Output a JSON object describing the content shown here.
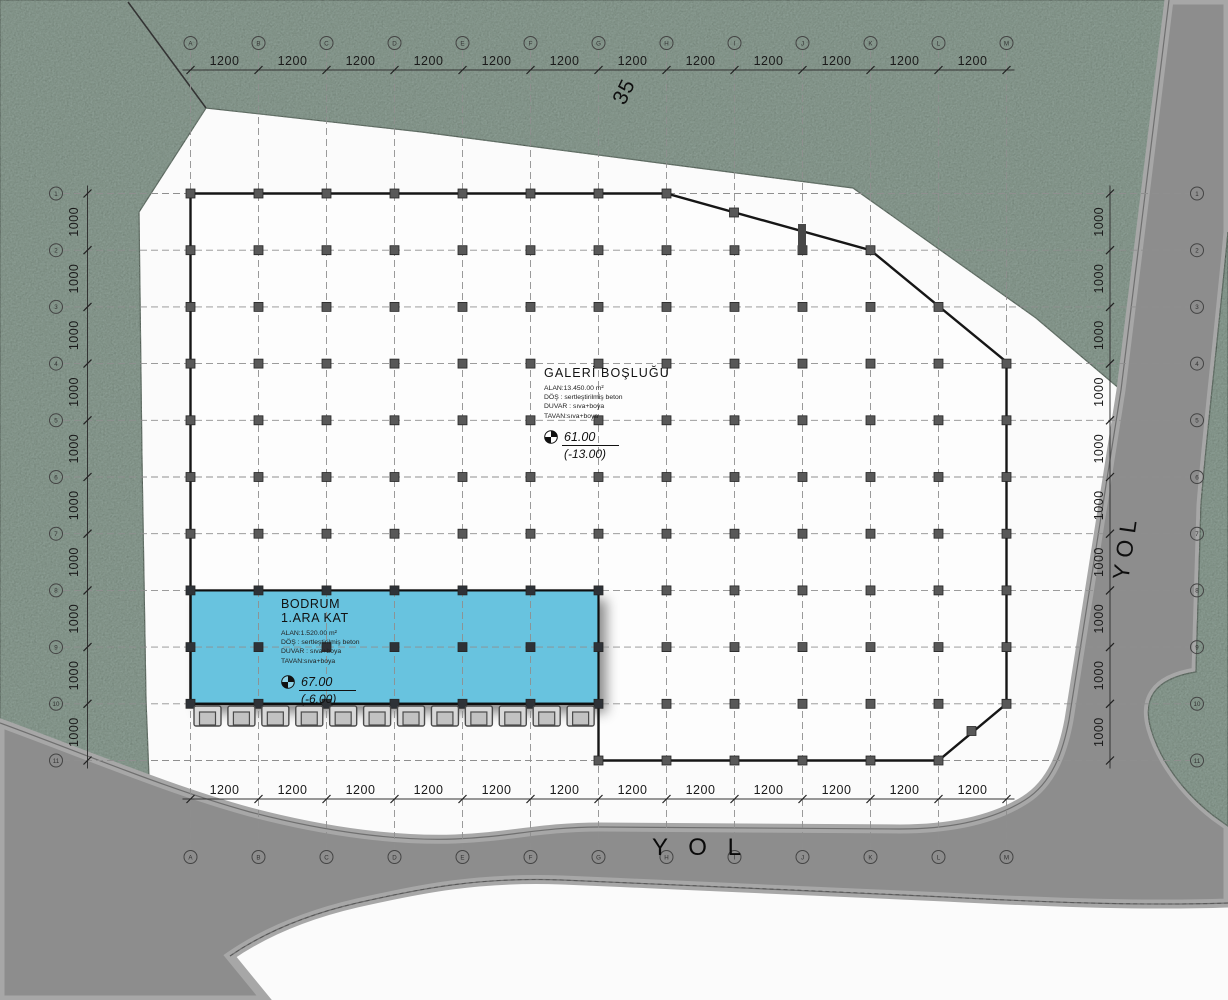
{
  "parcel_label": "35",
  "roads": {
    "bottom_label": "Y O L",
    "right_label": "YOL"
  },
  "grid": {
    "col_axis_labels": [
      "A",
      "B",
      "C",
      "D",
      "E",
      "F",
      "G",
      "H",
      "I",
      "J",
      "K",
      "L",
      "M"
    ],
    "row_axis_labels": [
      "1",
      "2",
      "3",
      "4",
      "5",
      "6",
      "7",
      "8",
      "9",
      "10",
      "11"
    ],
    "top_dim_labels": [
      "1200",
      "1200",
      "1200",
      "1200",
      "1200",
      "1200",
      "1200",
      "1200",
      "1200",
      "1200",
      "1200",
      "1200"
    ],
    "bottom_dim_labels": [
      "1200",
      "1200",
      "1200",
      "1200",
      "1200",
      "1200",
      "1200",
      "1200",
      "1200",
      "1200",
      "1200",
      "1200"
    ],
    "left_dim_labels": [
      "1000",
      "1000",
      "1000",
      "1000",
      "1000",
      "1000",
      "1000",
      "1000",
      "1000",
      "1000"
    ],
    "right_dim_labels": [
      "1000",
      "1000",
      "1000",
      "1000",
      "1000",
      "1000",
      "1000",
      "1000",
      "1000",
      "1000"
    ]
  },
  "gallery": {
    "title": "GALERİ BOŞLUĞU",
    "specs": [
      "ALAN:13.450.00 m²",
      "DÖŞ : sertleştirilmiş beton",
      "DUVAR : sıva+boya",
      "TAVAN:sıva+boya"
    ],
    "level": "61.00",
    "level_below": "(-13.00)"
  },
  "basement": {
    "title_line1": "BODRUM",
    "title_line2": "1.ARA KAT",
    "specs": [
      "ALAN:1.520.00 m²",
      "DÖŞ : sertleştirilmiş beton",
      "DUVAR : sıva+boya",
      "TAVAN:sıva+boya"
    ],
    "level": "67.00",
    "level_below": "(-6.00)"
  },
  "colors": {
    "parcel_green": "#8b9c93",
    "road_gray": "#8d8d8d",
    "road_edge_light": "#a7a7a7",
    "highlight_blue": "#67c3df",
    "line_dark": "#161616",
    "column_gray": "#585858"
  }
}
